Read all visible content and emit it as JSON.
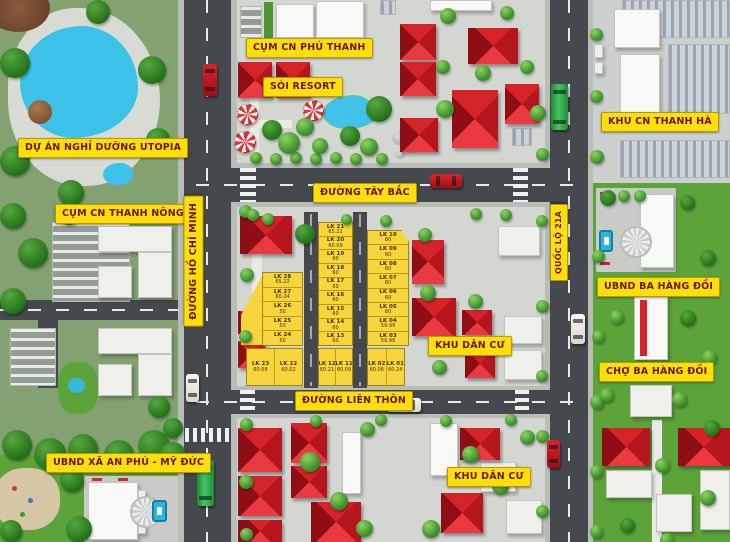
{
  "map": {
    "title": "Sơ đồ phân lô khu dân cư",
    "labels": {
      "utopia": "DỰ ÁN NGHỈ DƯỠNG UTOPIA",
      "cum_cn_thanh_nong": "CỤM CN THANH NÔNG",
      "ubnd_an_phu": "UBND XÃ AN PHÚ - MỸ ĐỨC",
      "cum_cn_phu_thanh": "CỤM CN PHÚ THANH",
      "soi_resort": "SÓI RESORT",
      "duong_tay_bac": "ĐƯỜNG TÂY BẮC",
      "duong_ho_chi_minh": "ĐƯỜNG HỒ CHÍ MINH",
      "duong_lien_thon": "ĐƯỜNG LIÊN THÔN",
      "khu_dan_cu_1": "KHU DÂN CƯ",
      "khu_dan_cu_2": "KHU DÂN CƯ",
      "quoc_lo_21a": "QUỐC LỘ 21A",
      "khu_cn_thanh_ha": "KHU CN THANH HÀ",
      "ubnd_ba_hang_doi": "UBND BA HÀNG ĐỒI",
      "cho_ba_hang_doi": "CHỢ BA HÀNG ĐỒI"
    },
    "lots": {
      "column_a": [
        {
          "name": "LK 28",
          "area": "65.22"
        },
        {
          "name": "LK 27",
          "area": "60.24"
        },
        {
          "name": "LK 26",
          "area": "50"
        },
        {
          "name": "LK 25",
          "area": "50"
        },
        {
          "name": "LK 24",
          "area": "50"
        }
      ],
      "column_a_bottom": [
        {
          "name": "LK 23",
          "area": "60.08"
        },
        {
          "name": "LK 22",
          "area": "60.02"
        }
      ],
      "column_b": [
        {
          "name": "LK 21",
          "area": "65.21"
        },
        {
          "name": "LK 20",
          "area": "60.09"
        },
        {
          "name": "LK 19",
          "area": "60"
        },
        {
          "name": "LK 18",
          "area": "60"
        },
        {
          "name": "LK 17",
          "area": "60"
        },
        {
          "name": "LK 16",
          "area": "60"
        },
        {
          "name": "LK 15",
          "area": "60"
        },
        {
          "name": "LK 14",
          "area": "60"
        },
        {
          "name": "LK 13",
          "area": "60"
        }
      ],
      "column_b_bottom": [
        {
          "name": "LK 12",
          "area": "60.21"
        },
        {
          "name": "LK 11",
          "area": "60.09"
        }
      ],
      "column_c": [
        {
          "name": "LK 10",
          "area": "60"
        },
        {
          "name": "LK 09",
          "area": "60"
        },
        {
          "name": "LK 08",
          "area": "60"
        },
        {
          "name": "LK 07",
          "area": "60"
        },
        {
          "name": "LK 06",
          "area": "60"
        },
        {
          "name": "LK 05",
          "area": "60"
        },
        {
          "name": "LK 04",
          "area": "59.99"
        },
        {
          "name": "LK 03",
          "area": "59.99"
        }
      ],
      "column_c_bottom": [
        {
          "name": "LK 02",
          "area": "60.06"
        },
        {
          "name": "LK 01",
          "area": "60.24"
        }
      ]
    },
    "colors": {
      "label_bg": "#ffdf0a",
      "label_text": "#6d1500",
      "lot_fill": "#f6d63c",
      "roof_red": "#d4242a",
      "road": "#45484c",
      "grass": "#5ca33a",
      "pool": "#41c3e9"
    }
  }
}
